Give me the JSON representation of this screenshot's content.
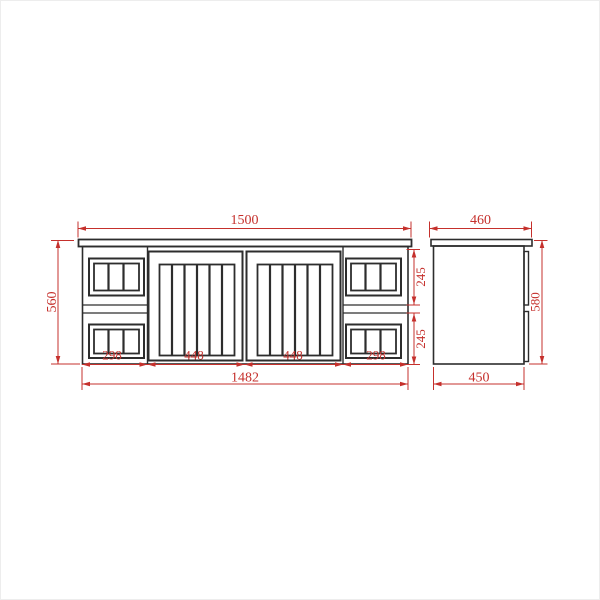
{
  "drawing": {
    "description": "Technical dimension drawing of a wall-hung vanity cabinet, front and side elevations",
    "units": "mm",
    "colors": {
      "dimension_red": "#c5302c",
      "line_black": "#2d2d2d",
      "background": "#ffffff"
    },
    "front": {
      "width": "1500",
      "height": "560",
      "base_width": "1482",
      "segments": {
        "s1": "298",
        "s2": "448",
        "s3": "448",
        "s4": "298"
      },
      "row_heights": {
        "upper": "245",
        "lower": "245"
      }
    },
    "side": {
      "depth_top": "460",
      "height": "580",
      "depth_bottom": "450"
    }
  }
}
